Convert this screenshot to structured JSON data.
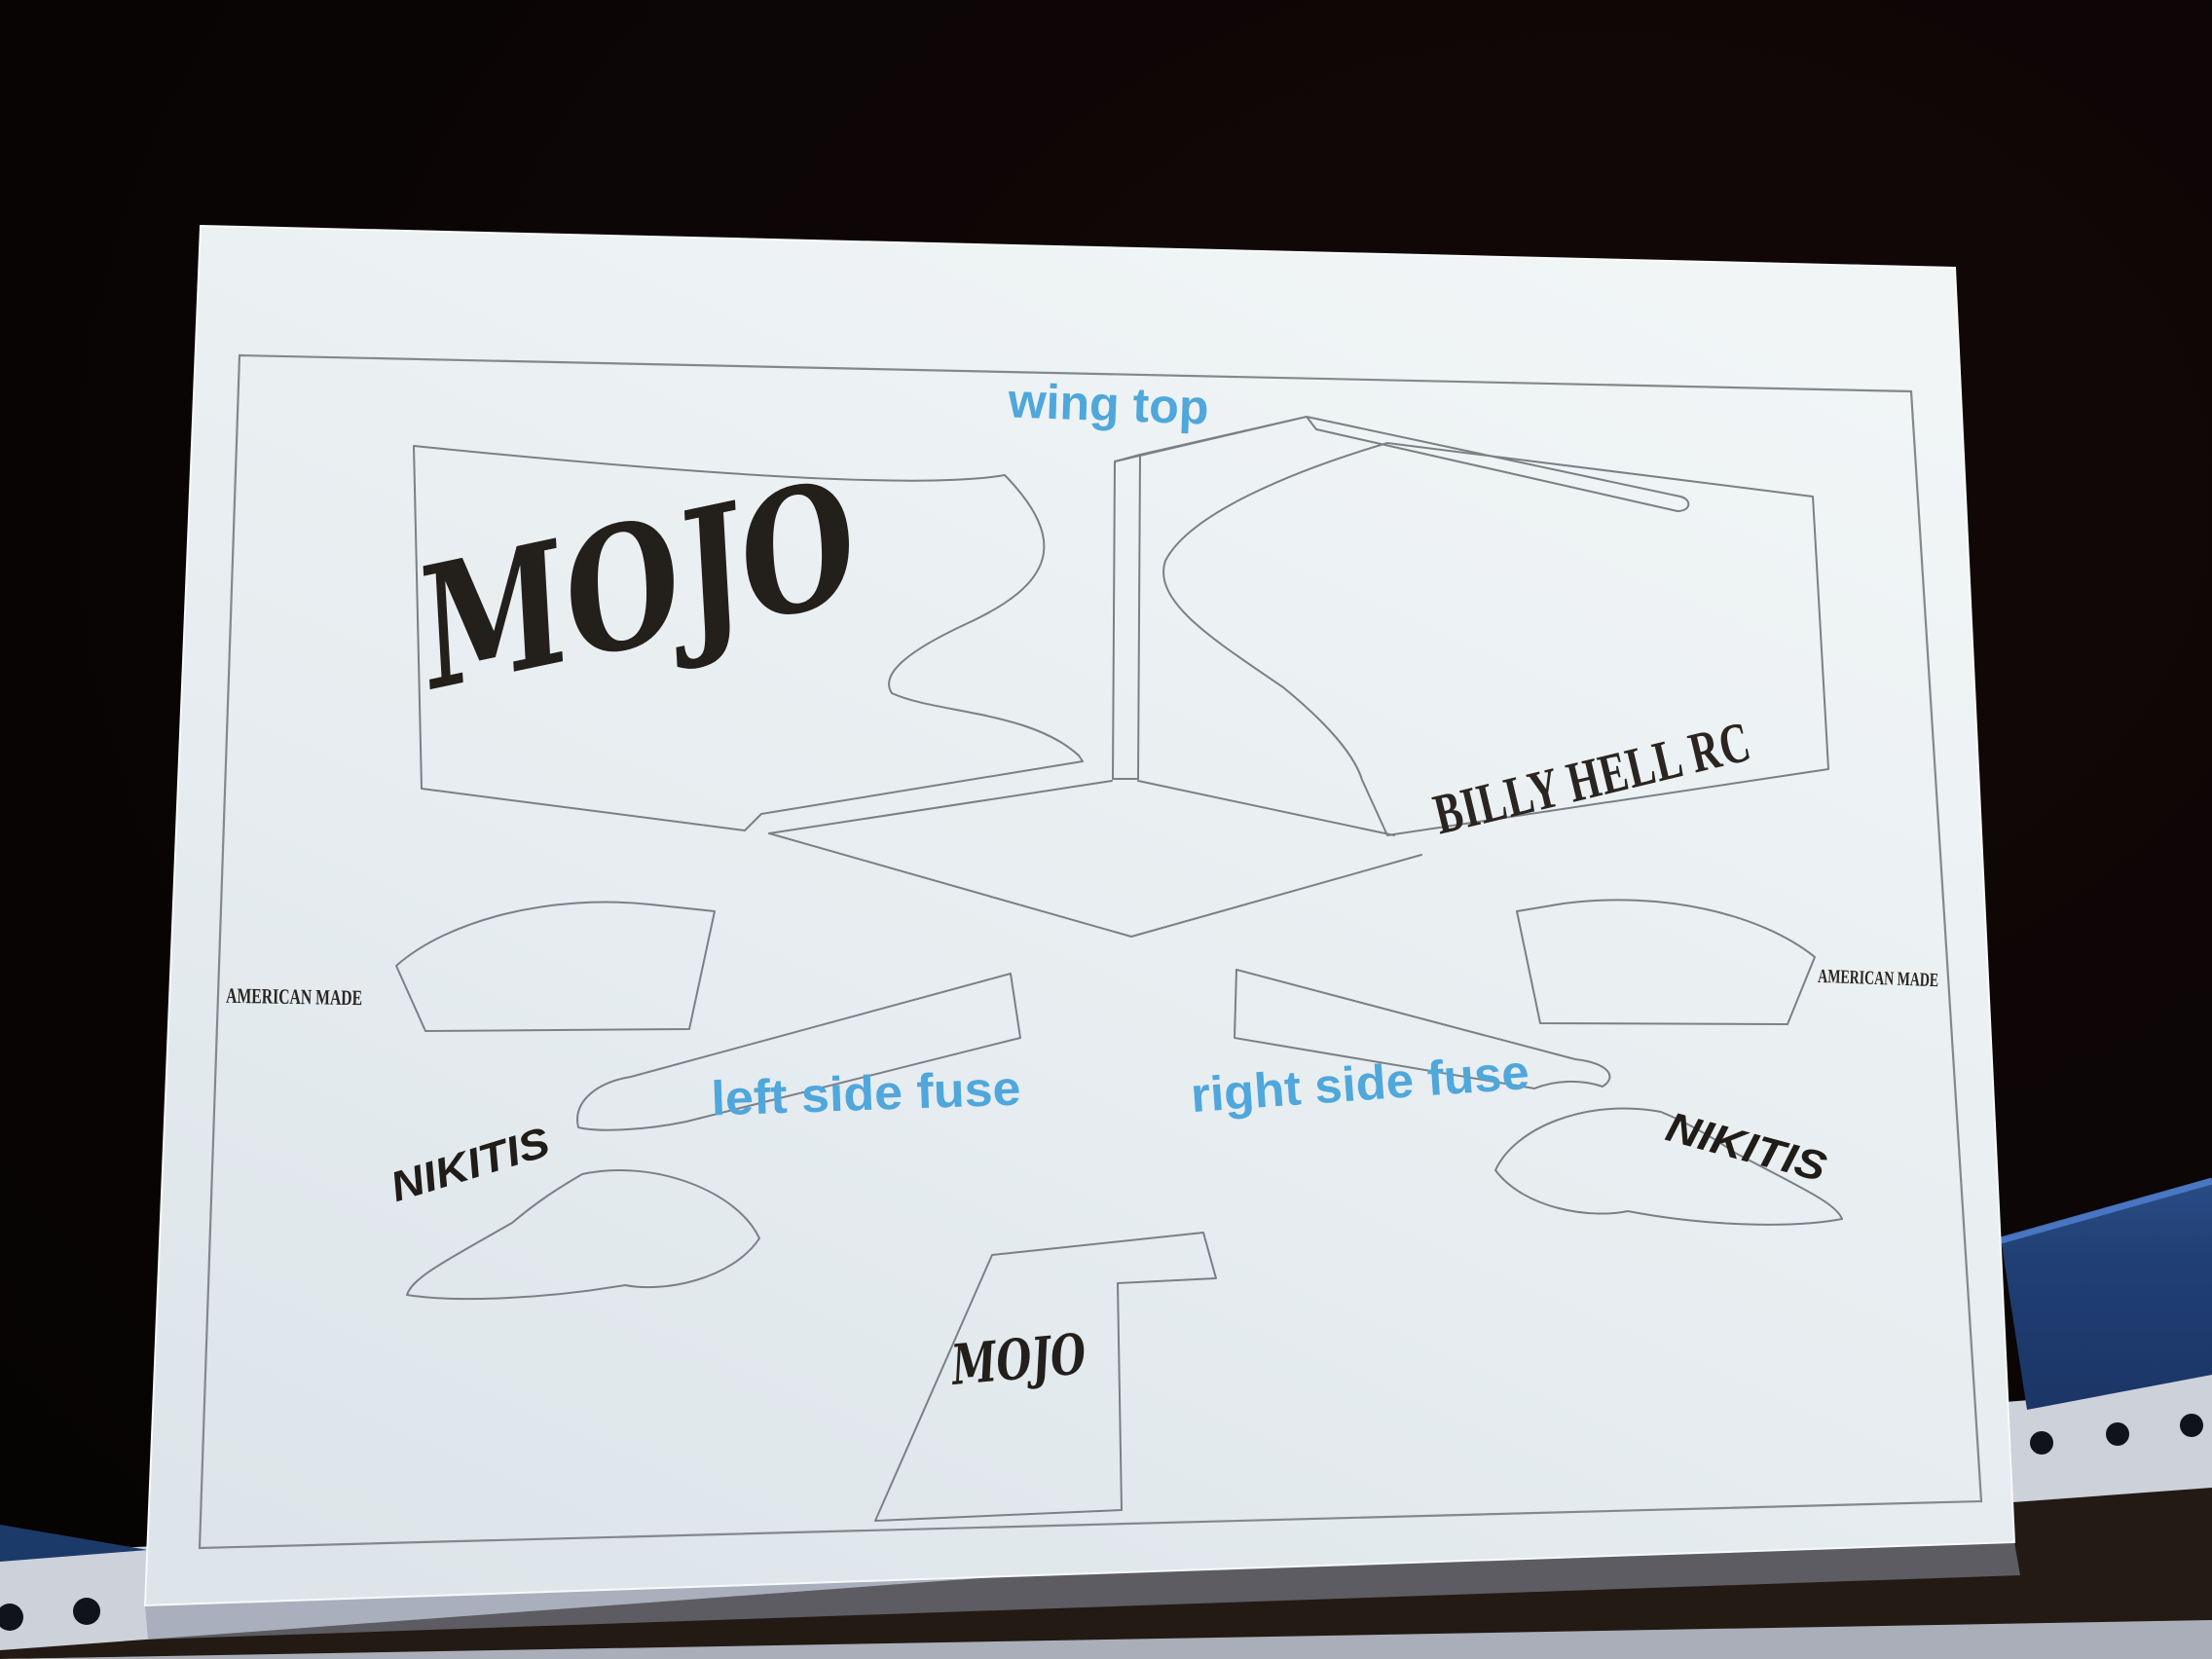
{
  "scene": {
    "description": "Photograph of a printed RC airplane decal template sheet on a desk",
    "background_color": "#070404",
    "paper_color": "#e9eef0",
    "outline_color": "#7b8086",
    "ink_color": "#231f1b",
    "accent_blue": "#4fa7db",
    "fabric_blue": "#1f3f75",
    "underpaper_color": "#ccd1da"
  },
  "labels": {
    "wing_top": "wing top",
    "left_side_fuse": "left side fuse",
    "right_side_fuse": "right side fuse"
  },
  "decal_texts": {
    "mojo_large": "MOJO",
    "billy_hell_rc": "BILLY HELL RC",
    "american_made_left": "AMERICAN MADE",
    "american_made_right": "AMERICAN MADE",
    "nikitis_left": "NIKITIS",
    "nikitis_right": "NIKITIS",
    "mojo_fin": "MOJO"
  }
}
